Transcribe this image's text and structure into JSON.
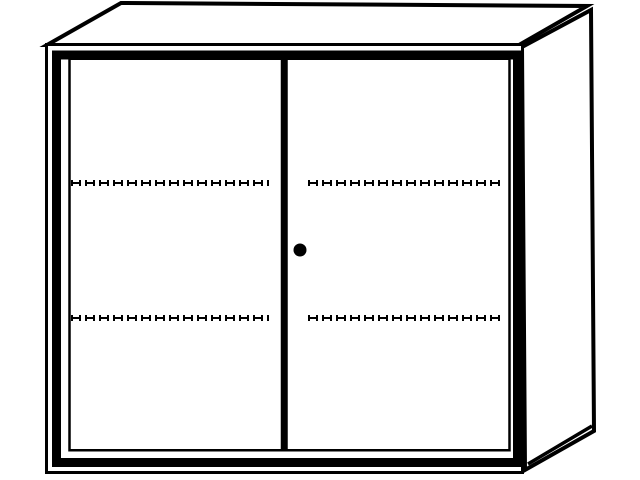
{
  "meta": {
    "description": "Monochrome technical line drawing of a two-door cabinet (sideboard) in slight right-side perspective on a plain white background",
    "text_content": "none"
  },
  "colors": {
    "line": "#000000",
    "surface": "#ffffff",
    "background": "#ffffff"
  },
  "cabinet": {
    "type": "two-door cabinet",
    "views": [
      "front face",
      "top face",
      "right side panel"
    ],
    "doors": [
      {
        "side": "left",
        "shelf_lines": 2
      },
      {
        "side": "right",
        "shelf_lines": 2,
        "lock": "round black knob left of door center edge"
      }
    ],
    "shelf_line_style": "dashed line with tick ends (adjustable shelf indication)",
    "shelf_rows": 2
  }
}
